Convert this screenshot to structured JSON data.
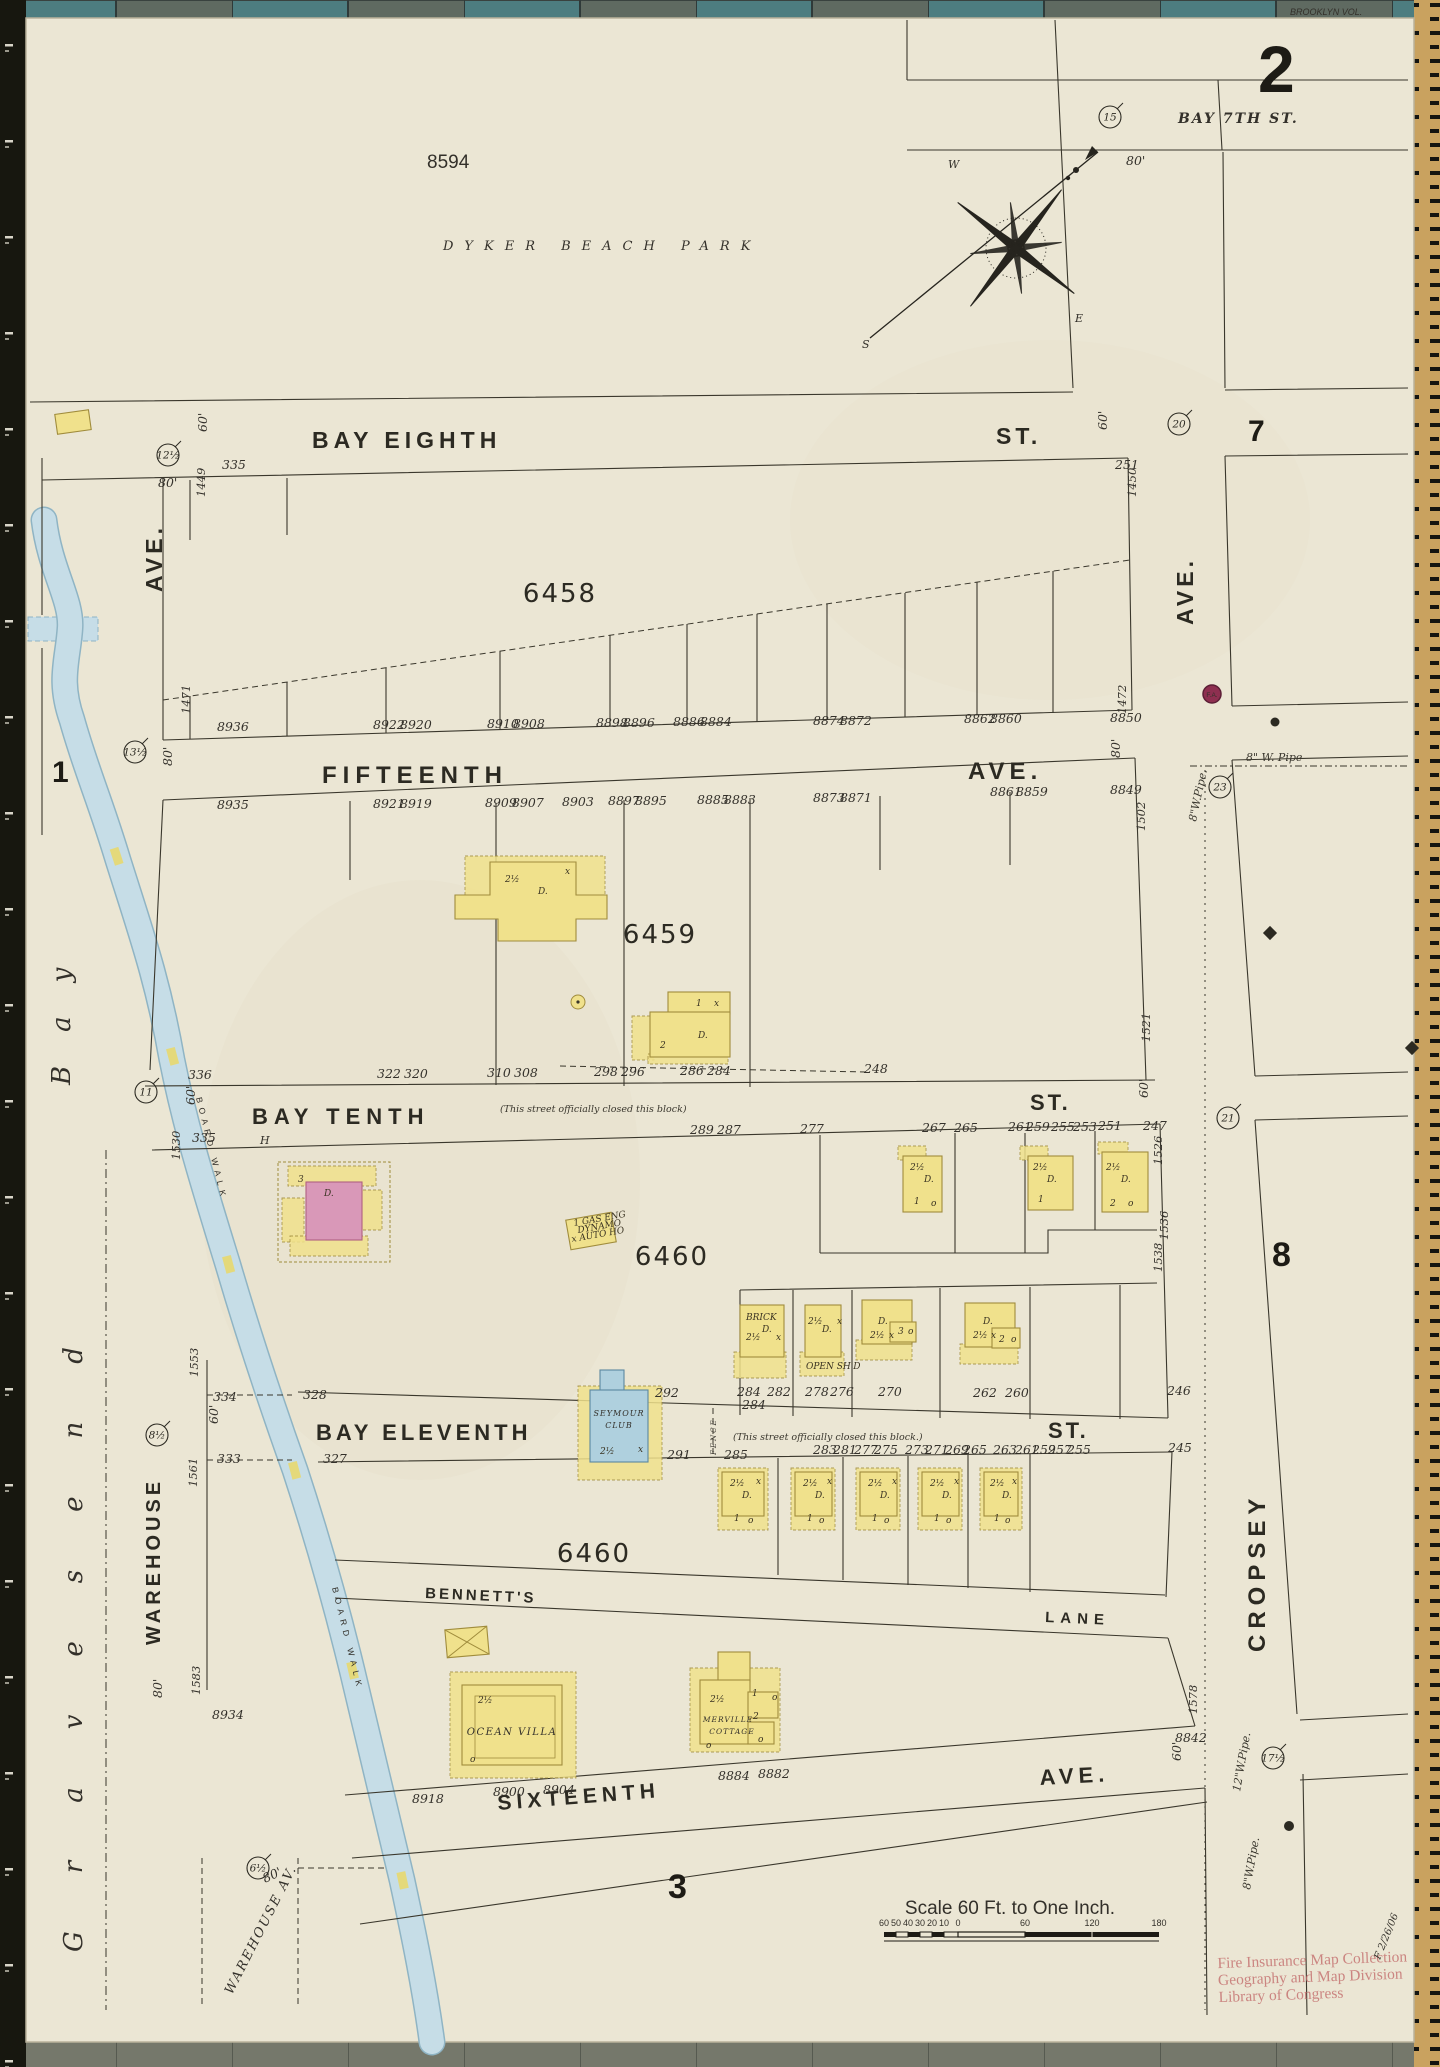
{
  "sheet": {
    "number": "2",
    "adjacent_left": "1",
    "adjacent_right_top": "7",
    "adjacent_right_mid": "8",
    "adjacent_bottom": "3",
    "volume_note": "BROOKLYN VOL."
  },
  "park": {
    "lot": "8594",
    "name": "DYKER BEACH PARK"
  },
  "compass": {
    "west": "W",
    "east": "E",
    "south": "S",
    "needle_dim": "80'"
  },
  "streets": {
    "bay_seventh": "BAY 7TH ST.",
    "bay_eighth": "BAY EIGHTH",
    "bay_eighth_suffix": "ST.",
    "fifteenth": "FIFTEENTH",
    "fifteenth_suffix": "AVE.",
    "bay_tenth": "BAY TENTH",
    "bay_tenth_suffix": "ST.",
    "bay_eleventh": "BAY ELEVENTH",
    "bay_eleventh_suffix": "ST.",
    "bennetts": "BENNETT'S",
    "bennetts_suffix": "LANE",
    "sixteenth": "SIXTEENTH",
    "sixteenth_suffix": "AVE.",
    "cropsey": "CROPSEY",
    "ave_upper_left": "AVE.",
    "ave_upper_right": "AVE.",
    "warehouse": "WAREHOUSE",
    "warehouse_av": "WAREHOUSE AV.",
    "closed_note_bay_tenth": "(This street officially closed this block)",
    "closed_note_bay_eleventh": "(This street officially closed this block.)",
    "fence": "FENCE",
    "hydrant_mark": "H"
  },
  "water": {
    "bay_word1": "Gravesend",
    "bay_word2": "Bay",
    "boardwalk": "BOARD WALK"
  },
  "blocks": {
    "b6458": "6458",
    "b6459": "6459",
    "b6460a": "6460",
    "b6460b": "6460"
  },
  "buildings": {
    "seymour_line1": "SEYMOUR",
    "seymour_line2": "CLUB",
    "ocean_villa": "OCEAN VILLA",
    "merville_line1": "MERVILLE",
    "merville_line2": "COTTAGE"
  },
  "pipes": {
    "horizontal_8": "8\" W. Pipe",
    "vertical_8_upper": "8\"W.Pipe.",
    "vertical_12": "12\"W.Pipe.",
    "vertical_8_lower": "8\"W.Pipe.",
    "fire_alarm": "F.A."
  },
  "scale_bar": {
    "title": "Scale 60 Ft. to One Inch.",
    "tick_labels": [
      {
        "t": "60",
        "x": 884,
        "y": 1926
      },
      {
        "t": "50",
        "x": 896,
        "y": 1926
      },
      {
        "t": "40",
        "x": 908,
        "y": 1926
      },
      {
        "t": "30",
        "x": 920,
        "y": 1926
      },
      {
        "t": "20",
        "x": 932,
        "y": 1926
      },
      {
        "t": "10",
        "x": 944,
        "y": 1926
      },
      {
        "t": "0",
        "x": 958,
        "y": 1926
      },
      {
        "t": "60",
        "x": 1025,
        "y": 1926
      },
      {
        "t": "120",
        "x": 1092,
        "y": 1926
      },
      {
        "t": "180",
        "x": 1159,
        "y": 1926
      }
    ]
  },
  "stamp": {
    "line1": "Fire Insurance Map Collection",
    "line2": "Geography and Map Division",
    "line3": "Library of Congress",
    "annotation": "F 2/26/06"
  },
  "colors": {
    "page": "#ebe6d4",
    "mat": "#6f7468",
    "building_yellow": "#f0e18c",
    "building_pink": "#d998b8",
    "building_blue": "#afd0de",
    "water": "#c6dde7",
    "stamp_red": "#c4706f",
    "fire_alarm_red": "#8e2f50"
  },
  "circled_numbers": [
    {
      "t": "15",
      "x": 1110,
      "y": 117
    },
    {
      "t": "20",
      "x": 1179,
      "y": 424
    },
    {
      "t": "12½",
      "x": 168,
      "y": 455
    },
    {
      "t": "13½",
      "x": 135,
      "y": 752
    },
    {
      "t": "23",
      "x": 1220,
      "y": 787
    },
    {
      "t": "11",
      "x": 146,
      "y": 1092
    },
    {
      "t": "21",
      "x": 1228,
      "y": 1118
    },
    {
      "t": "8½",
      "x": 157,
      "y": 1435
    },
    {
      "t": "6½",
      "x": 258,
      "y": 1868
    },
    {
      "t": "17½",
      "x": 1273,
      "y": 1758
    }
  ],
  "parcel_numbers": [
    {
      "t": "1449",
      "x": 205,
      "y": 497,
      "r": -90
    },
    {
      "t": "1471",
      "x": 190,
      "y": 714,
      "r": -90
    },
    {
      "t": "1530",
      "x": 180,
      "y": 1160,
      "r": -90
    },
    {
      "t": "1553",
      "x": 198,
      "y": 1377,
      "r": -90
    },
    {
      "t": "1561",
      "x": 197,
      "y": 1487,
      "r": -90
    },
    {
      "t": "1583",
      "x": 200,
      "y": 1695,
      "r": -90
    },
    {
      "t": "1450",
      "x": 1136,
      "y": 497,
      "r": -90
    },
    {
      "t": "1472",
      "x": 1126,
      "y": 714,
      "r": -90
    },
    {
      "t": "1502",
      "x": 1145,
      "y": 831,
      "r": -90
    },
    {
      "t": "1521",
      "x": 1150,
      "y": 1042,
      "r": -90
    },
    {
      "t": "1526",
      "x": 1162,
      "y": 1165,
      "r": -90
    },
    {
      "t": "1536",
      "x": 1168,
      "y": 1240,
      "r": -90
    },
    {
      "t": "1538",
      "x": 1162,
      "y": 1272,
      "r": -90
    },
    {
      "t": "1578",
      "x": 1197,
      "y": 1714,
      "r": -90
    }
  ],
  "street_dims": [
    {
      "t": "60'",
      "x": 207,
      "y": 432,
      "r": -90
    },
    {
      "t": "60'",
      "x": 1107,
      "y": 430,
      "r": -90
    },
    {
      "t": "60'",
      "x": 195,
      "y": 1105,
      "r": -90
    },
    {
      "t": "60'",
      "x": 1148,
      "y": 1098,
      "r": -90
    },
    {
      "t": "60'",
      "x": 218,
      "y": 1424,
      "r": -90
    },
    {
      "t": "60'",
      "x": 1181,
      "y": 1761,
      "r": -90
    },
    {
      "t": "80'",
      "x": 158,
      "y": 487,
      "r": 0
    },
    {
      "t": "80'",
      "x": 172,
      "y": 766,
      "r": -90
    },
    {
      "t": "80'",
      "x": 1120,
      "y": 758,
      "r": -90
    },
    {
      "t": "80'",
      "x": 162,
      "y": 1698,
      "r": -90
    },
    {
      "t": "80'",
      "x": 265,
      "y": 1883,
      "r": -25
    },
    {
      "t": "80'",
      "x": 1126,
      "y": 165,
      "r": 0
    }
  ],
  "lot_numbers": [
    {
      "t": "335",
      "x": 222,
      "y": 469
    },
    {
      "t": "251",
      "x": 1115,
      "y": 469
    },
    {
      "t": "8936",
      "x": 217,
      "y": 731
    },
    {
      "t": "8922",
      "x": 373,
      "y": 729
    },
    {
      "t": "8920",
      "x": 400,
      "y": 729
    },
    {
      "t": "8910",
      "x": 487,
      "y": 728
    },
    {
      "t": "8908",
      "x": 513,
      "y": 728
    },
    {
      "t": "8898",
      "x": 596,
      "y": 727
    },
    {
      "t": "8896",
      "x": 623,
      "y": 727
    },
    {
      "t": "8886",
      "x": 673,
      "y": 726
    },
    {
      "t": "8884",
      "x": 700,
      "y": 726
    },
    {
      "t": "8874",
      "x": 813,
      "y": 725
    },
    {
      "t": "8872",
      "x": 840,
      "y": 725
    },
    {
      "t": "8862",
      "x": 964,
      "y": 723
    },
    {
      "t": "8860",
      "x": 990,
      "y": 723
    },
    {
      "t": "8850",
      "x": 1110,
      "y": 722
    },
    {
      "t": "8935",
      "x": 217,
      "y": 809
    },
    {
      "t": "8921",
      "x": 373,
      "y": 808
    },
    {
      "t": "8919",
      "x": 400,
      "y": 808
    },
    {
      "t": "8909",
      "x": 485,
      "y": 807
    },
    {
      "t": "8907",
      "x": 512,
      "y": 807
    },
    {
      "t": "8903",
      "x": 562,
      "y": 806
    },
    {
      "t": "8897",
      "x": 608,
      "y": 805
    },
    {
      "t": "8895",
      "x": 635,
      "y": 805
    },
    {
      "t": "8885",
      "x": 697,
      "y": 804
    },
    {
      "t": "8883",
      "x": 724,
      "y": 804
    },
    {
      "t": "8873",
      "x": 813,
      "y": 802
    },
    {
      "t": "8871",
      "x": 840,
      "y": 802
    },
    {
      "t": "8861",
      "x": 990,
      "y": 796
    },
    {
      "t": "8859",
      "x": 1016,
      "y": 796
    },
    {
      "t": "8849",
      "x": 1110,
      "y": 794
    },
    {
      "t": "336",
      "x": 188,
      "y": 1079
    },
    {
      "t": "322",
      "x": 377,
      "y": 1078
    },
    {
      "t": "320",
      "x": 404,
      "y": 1078
    },
    {
      "t": "310",
      "x": 487,
      "y": 1077
    },
    {
      "t": "308",
      "x": 514,
      "y": 1077
    },
    {
      "t": "298",
      "x": 594,
      "y": 1076
    },
    {
      "t": "296",
      "x": 621,
      "y": 1076
    },
    {
      "t": "286",
      "x": 680,
      "y": 1075
    },
    {
      "t": "284",
      "x": 707,
      "y": 1075
    },
    {
      "t": "248",
      "x": 864,
      "y": 1073
    },
    {
      "t": "335",
      "x": 192,
      "y": 1142
    },
    {
      "t": "289",
      "x": 690,
      "y": 1134
    },
    {
      "t": "287",
      "x": 717,
      "y": 1134
    },
    {
      "t": "277",
      "x": 800,
      "y": 1133
    },
    {
      "t": "267",
      "x": 922,
      "y": 1132
    },
    {
      "t": "265",
      "x": 954,
      "y": 1132
    },
    {
      "t": "261",
      "x": 1008,
      "y": 1131
    },
    {
      "t": "259",
      "x": 1026,
      "y": 1131
    },
    {
      "t": "255",
      "x": 1051,
      "y": 1131
    },
    {
      "t": "253",
      "x": 1073,
      "y": 1131
    },
    {
      "t": "251",
      "x": 1098,
      "y": 1130
    },
    {
      "t": "247",
      "x": 1143,
      "y": 1130
    },
    {
      "t": "328",
      "x": 303,
      "y": 1399
    },
    {
      "t": "327",
      "x": 323,
      "y": 1463
    },
    {
      "t": "284",
      "x": 737,
      "y": 1396
    },
    {
      "t": "282",
      "x": 767,
      "y": 1396
    },
    {
      "t": "278",
      "x": 805,
      "y": 1396
    },
    {
      "t": "276",
      "x": 830,
      "y": 1396
    },
    {
      "t": "270",
      "x": 878,
      "y": 1396
    },
    {
      "t": "262",
      "x": 973,
      "y": 1397
    },
    {
      "t": "260",
      "x": 1005,
      "y": 1397
    },
    {
      "t": "246",
      "x": 1167,
      "y": 1395
    },
    {
      "t": "284",
      "x": 742,
      "y": 1409
    },
    {
      "t": "292",
      "x": 655,
      "y": 1397
    },
    {
      "t": "291",
      "x": 667,
      "y": 1459
    },
    {
      "t": "285",
      "x": 724,
      "y": 1459
    },
    {
      "t": "283",
      "x": 813,
      "y": 1454
    },
    {
      "t": "281",
      "x": 833,
      "y": 1454
    },
    {
      "t": "277",
      "x": 854,
      "y": 1454
    },
    {
      "t": "275",
      "x": 874,
      "y": 1454
    },
    {
      "t": "273",
      "x": 905,
      "y": 1454
    },
    {
      "t": "271",
      "x": 925,
      "y": 1454
    },
    {
      "t": "269",
      "x": 945,
      "y": 1454
    },
    {
      "t": "265",
      "x": 963,
      "y": 1454
    },
    {
      "t": "263",
      "x": 993,
      "y": 1454
    },
    {
      "t": "261",
      "x": 1015,
      "y": 1454
    },
    {
      "t": "259",
      "x": 1032,
      "y": 1454
    },
    {
      "t": "257",
      "x": 1048,
      "y": 1454
    },
    {
      "t": "255",
      "x": 1067,
      "y": 1454
    },
    {
      "t": "245",
      "x": 1168,
      "y": 1452
    },
    {
      "t": "8918",
      "x": 412,
      "y": 1803
    },
    {
      "t": "8900",
      "x": 493,
      "y": 1796
    },
    {
      "t": "8904",
      "x": 543,
      "y": 1794
    },
    {
      "t": "8884",
      "x": 718,
      "y": 1780
    },
    {
      "t": "8882",
      "x": 758,
      "y": 1778
    },
    {
      "t": "8842",
      "x": 1175,
      "y": 1742
    },
    {
      "t": "8934",
      "x": 212,
      "y": 1719
    },
    {
      "t": "334",
      "x": 213,
      "y": 1401
    },
    {
      "t": "333",
      "x": 217,
      "y": 1463
    }
  ],
  "house_marks": [
    {
      "t": "2½",
      "x": 505,
      "y": 882
    },
    {
      "t": "D.",
      "x": 538,
      "y": 894
    },
    {
      "t": "x",
      "x": 565,
      "y": 874
    },
    {
      "t": "1",
      "x": 696,
      "y": 1006
    },
    {
      "t": "x",
      "x": 714,
      "y": 1006
    },
    {
      "t": "2",
      "x": 660,
      "y": 1048
    },
    {
      "t": "D.",
      "x": 698,
      "y": 1038
    },
    {
      "t": "3",
      "x": 298,
      "y": 1182
    },
    {
      "t": "D.",
      "x": 324,
      "y": 1196
    },
    {
      "t": "1 GAS ENG",
      "x": 574,
      "y": 1226,
      "r": -10,
      "s": 5
    },
    {
      "t": "DYNAMO",
      "x": 578,
      "y": 1233,
      "r": -10,
      "s": 5
    },
    {
      "t": "x AUTO HO",
      "x": 572,
      "y": 1242,
      "r": -10,
      "s": 5
    },
    {
      "t": "2½",
      "x": 910,
      "y": 1170
    },
    {
      "t": "D.",
      "x": 924,
      "y": 1182
    },
    {
      "t": "1",
      "x": 914,
      "y": 1204
    },
    {
      "t": "o",
      "x": 931,
      "y": 1206
    },
    {
      "t": "2½",
      "x": 1033,
      "y": 1170
    },
    {
      "t": "D.",
      "x": 1047,
      "y": 1182
    },
    {
      "t": "1",
      "x": 1038,
      "y": 1202
    },
    {
      "t": "2½",
      "x": 1106,
      "y": 1170
    },
    {
      "t": "D.",
      "x": 1121,
      "y": 1182
    },
    {
      "t": "2",
      "x": 1110,
      "y": 1206
    },
    {
      "t": "o",
      "x": 1128,
      "y": 1206
    },
    {
      "t": "BRICK",
      "x": 746,
      "y": 1320,
      "s": 6
    },
    {
      "t": "2½",
      "x": 746,
      "y": 1340
    },
    {
      "t": "D.",
      "x": 762,
      "y": 1332
    },
    {
      "t": "x",
      "x": 776,
      "y": 1340
    },
    {
      "t": "2½",
      "x": 808,
      "y": 1324
    },
    {
      "t": "D.",
      "x": 822,
      "y": 1332
    },
    {
      "t": "x",
      "x": 837,
      "y": 1324
    },
    {
      "t": "OPEN SH'D",
      "x": 806,
      "y": 1369,
      "s": 5
    },
    {
      "t": "D.",
      "x": 878,
      "y": 1324
    },
    {
      "t": "2½",
      "x": 870,
      "y": 1338
    },
    {
      "t": "x",
      "x": 889,
      "y": 1338
    },
    {
      "t": "3",
      "x": 898,
      "y": 1334
    },
    {
      "t": "o",
      "x": 908,
      "y": 1334
    },
    {
      "t": "D.",
      "x": 983,
      "y": 1324
    },
    {
      "t": "2½",
      "x": 973,
      "y": 1338
    },
    {
      "t": "x",
      "x": 991,
      "y": 1338
    },
    {
      "t": "2",
      "x": 999,
      "y": 1342
    },
    {
      "t": "o",
      "x": 1011,
      "y": 1342
    },
    {
      "t": "2½",
      "x": 600,
      "y": 1454
    },
    {
      "t": "x",
      "x": 638,
      "y": 1452
    },
    {
      "t": "2½",
      "x": 730,
      "y": 1486
    },
    {
      "t": "D.",
      "x": 742,
      "y": 1498
    },
    {
      "t": "x",
      "x": 756,
      "y": 1484
    },
    {
      "t": "1",
      "x": 734,
      "y": 1521
    },
    {
      "t": "o",
      "x": 748,
      "y": 1523
    },
    {
      "t": "2½",
      "x": 803,
      "y": 1486
    },
    {
      "t": "D.",
      "x": 815,
      "y": 1498
    },
    {
      "t": "x",
      "x": 827,
      "y": 1484
    },
    {
      "t": "1",
      "x": 807,
      "y": 1521
    },
    {
      "t": "o",
      "x": 819,
      "y": 1523
    },
    {
      "t": "2½",
      "x": 868,
      "y": 1486
    },
    {
      "t": "D.",
      "x": 880,
      "y": 1498
    },
    {
      "t": "x",
      "x": 892,
      "y": 1484
    },
    {
      "t": "1",
      "x": 872,
      "y": 1521
    },
    {
      "t": "o",
      "x": 884,
      "y": 1523
    },
    {
      "t": "2½",
      "x": 930,
      "y": 1486
    },
    {
      "t": "D.",
      "x": 942,
      "y": 1498
    },
    {
      "t": "x",
      "x": 954,
      "y": 1484
    },
    {
      "t": "1",
      "x": 934,
      "y": 1521
    },
    {
      "t": "o",
      "x": 946,
      "y": 1523
    },
    {
      "t": "2½",
      "x": 990,
      "y": 1486
    },
    {
      "t": "D.",
      "x": 1002,
      "y": 1498
    },
    {
      "t": "x",
      "x": 1012,
      "y": 1484
    },
    {
      "t": "1",
      "x": 994,
      "y": 1521
    },
    {
      "t": "o",
      "x": 1005,
      "y": 1523
    },
    {
      "t": "2½",
      "x": 478,
      "y": 1703
    },
    {
      "t": "o",
      "x": 470,
      "y": 1762
    },
    {
      "t": "2½",
      "x": 710,
      "y": 1702
    },
    {
      "t": "1",
      "x": 752,
      "y": 1696
    },
    {
      "t": "2",
      "x": 753,
      "y": 1719
    },
    {
      "t": "o",
      "x": 772,
      "y": 1700
    },
    {
      "t": "o",
      "x": 758,
      "y": 1742
    },
    {
      "t": "o",
      "x": 706,
      "y": 1748
    }
  ]
}
